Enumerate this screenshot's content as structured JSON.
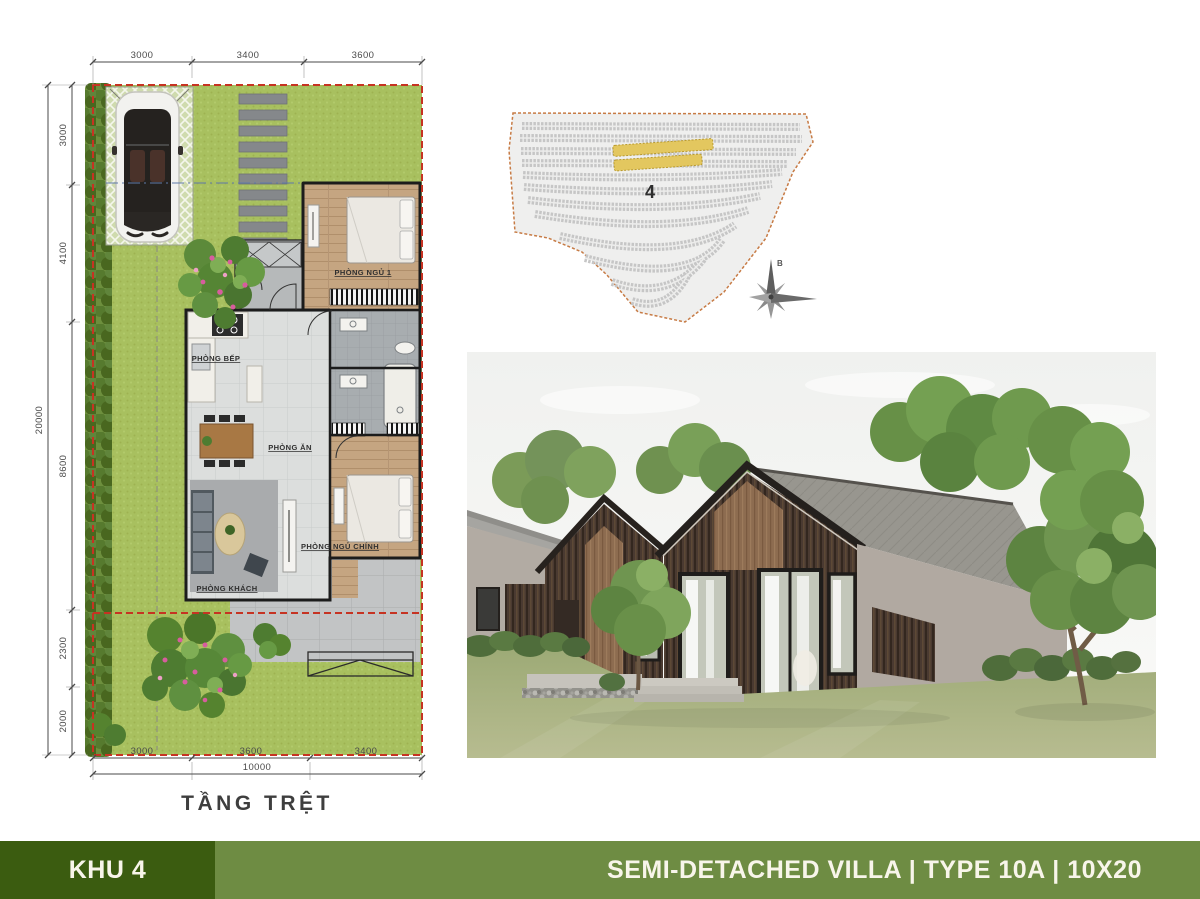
{
  "floor_plan": {
    "title": "TẦNG TRỆT",
    "dims": {
      "top": [
        "3000",
        "3400",
        "3600"
      ],
      "left": [
        "3000",
        "4100",
        "8600",
        "2300",
        "2000"
      ],
      "left_total": "20000",
      "bottom": [
        "3000",
        "3600",
        "3400"
      ],
      "bottom_total": "10000"
    },
    "rooms": {
      "bedroom1": "PHÒNG NGỦ 1",
      "kitchen": "PHÒNG BẾP",
      "dining": "PHÒNG ĂN",
      "master_bedroom": "PHÒNG NGỦ CHÍNH",
      "living": "PHÒNG KHÁCH"
    }
  },
  "site_map": {
    "zone_label": "4",
    "compass_north_label": "B",
    "highlight_color": "#e3c75f",
    "boundary_color": "#c77b45"
  },
  "footer": {
    "zone_title": "KHU 4",
    "villa_title": "SEMI-DETACHED VILLA | TYPE 10A | 10X20",
    "zone_bg": "#3b5c10",
    "title_bg": "#6e8c43",
    "text_color": "#f8f5ea"
  },
  "plan_colors": {
    "grass": "#a8c05f",
    "lot_boundary_red": "#c63322",
    "wall": "#1c1c1c",
    "tile_floor": "#dcdedd",
    "wood_floor": "#c5a581"
  }
}
